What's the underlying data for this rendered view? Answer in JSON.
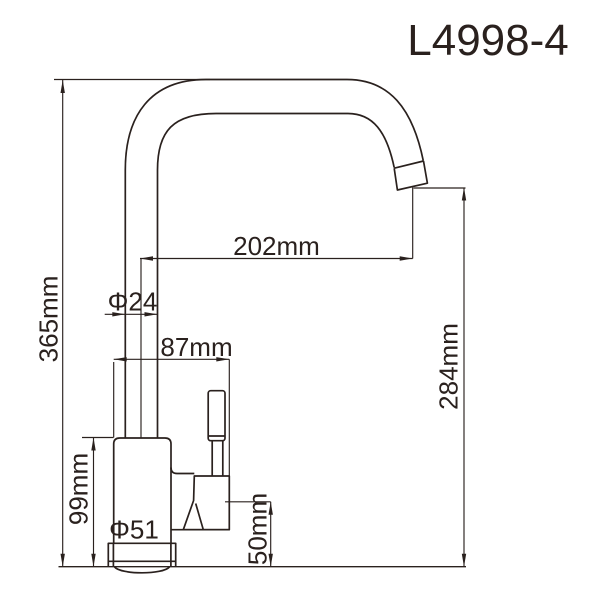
{
  "title": "L4998-4",
  "labels": {
    "overall_height": "365mm",
    "spout_reach": "202mm",
    "spout_diameter": "Φ24",
    "body_to_handle_width": "87mm",
    "outlet_height": "284mm",
    "body_height": "99mm",
    "base_diameter": "Φ51",
    "handle_joint_height": "50mm"
  },
  "colors": {
    "line": "#2a211e",
    "background": "#ffffff"
  }
}
